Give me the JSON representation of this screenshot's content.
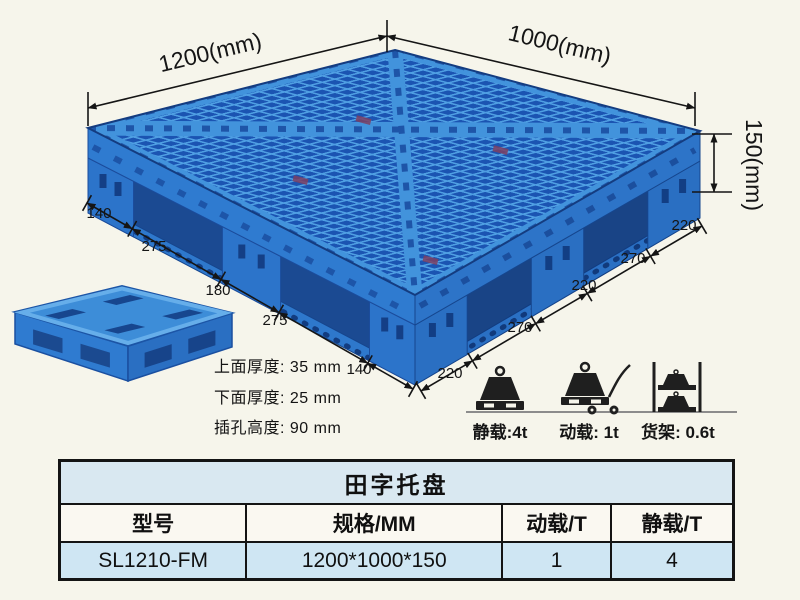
{
  "colors": {
    "background": "#f6f5eb",
    "pallet_blue": "#2f7bd0",
    "pallet_rib_light": "#4f9fe3",
    "pallet_hole_dark": "#1b54b2",
    "dimension_line": "#151515",
    "table_band_blue": "#cfe6f3"
  },
  "diagram": {
    "dim_1200": "1200(mm)",
    "dim_1000": "1000(mm)",
    "dim_150": "150(mm)",
    "left_ticks": [
      "140",
      "275",
      "180",
      "275",
      "140"
    ],
    "right_ticks": [
      "220",
      "270",
      "220",
      "270",
      "220"
    ],
    "notes": [
      "上面厚度: 35 mm",
      "下面厚度: 25 mm",
      "插孔高度: 90 mm"
    ],
    "loads": [
      {
        "icon": "static-load-weight",
        "label": "静载:4t"
      },
      {
        "icon": "dynamic-load-trolley",
        "label": "动载: 1t"
      },
      {
        "icon": "rack-load-shelf",
        "label": "货架: 0.6t"
      }
    ]
  },
  "table": {
    "title": "田字托盘",
    "headers": [
      "型号",
      "规格/MM",
      "动载/T",
      "静载/T"
    ],
    "rows": [
      [
        "SL1210-FM",
        "1200*1000*150",
        "1",
        "4"
      ]
    ]
  }
}
